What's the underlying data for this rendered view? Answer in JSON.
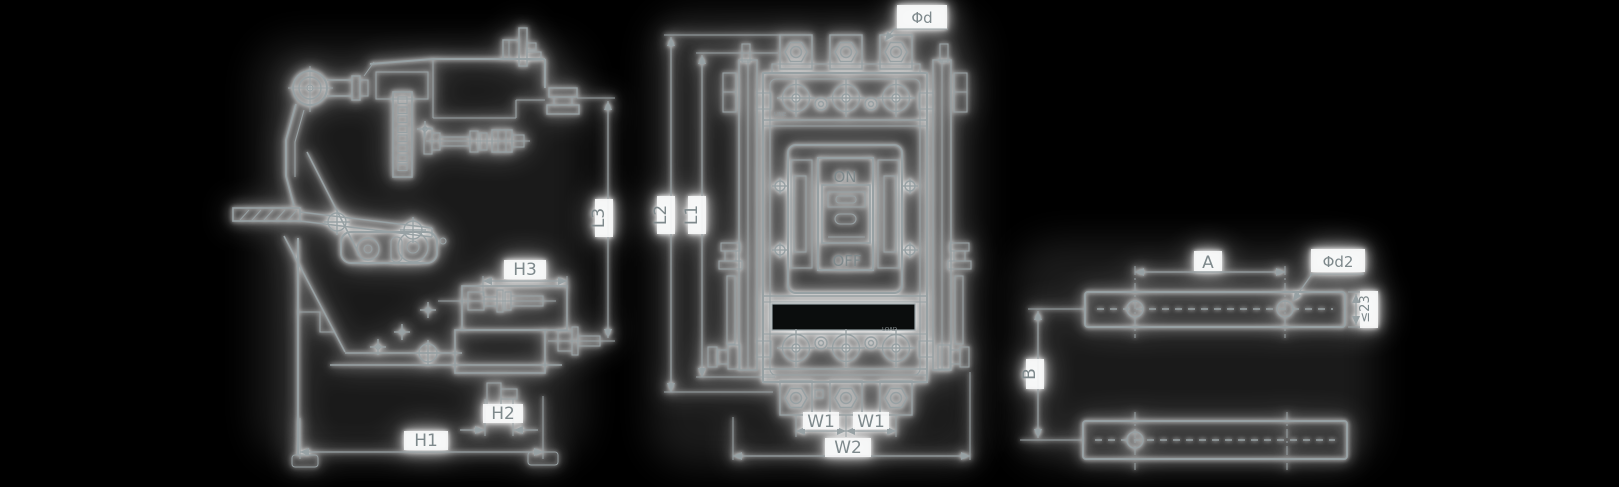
{
  "canvas": {
    "width": 1619,
    "height": 487,
    "background_color": "#000000",
    "line_color": "#97a1a4",
    "label_color": "#7e898c",
    "description": "Technical outline and mounting-dimension drawing of a 3-pole molded case circuit breaker: side view, front view, and mounting hole template"
  },
  "side_view": {
    "dims": {
      "h1": "H1",
      "h2": "H2",
      "h3": "H3",
      "l3": "L3"
    }
  },
  "front_view": {
    "switch": {
      "on": "ON",
      "off": "OFF"
    },
    "markings": {
      "line": "LINE",
      "load": "LOAD"
    },
    "dims": {
      "l1": "L1",
      "l2": "L2",
      "w1_left": "W1",
      "w1_right": "W1",
      "w2": "W2",
      "phi_d": "Φd"
    }
  },
  "mounting_view": {
    "dims": {
      "a": "A",
      "b": "B",
      "phi_d2": "Φd2",
      "bar_height_max": "≤23"
    }
  }
}
